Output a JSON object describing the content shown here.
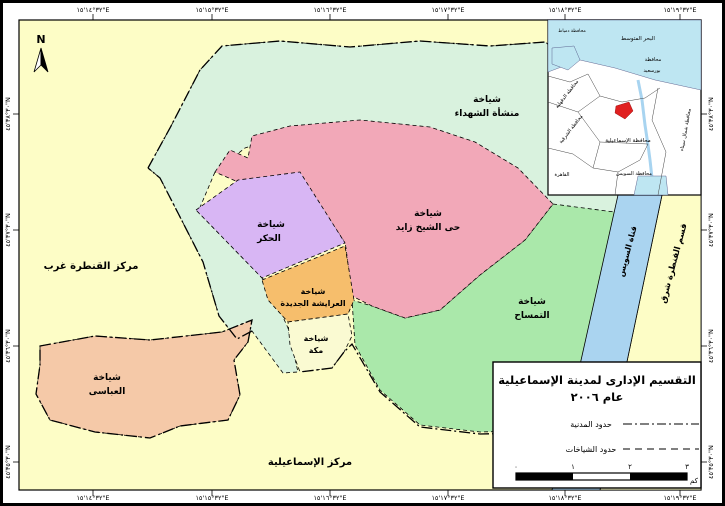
{
  "map": {
    "north_label": "N",
    "top_coords": [
      "٣٢°١٤'١٥\"E",
      "٣٢°١٥'١٥\"E",
      "٣٢°١٦'١٥\"E",
      "٣٢°١٧'١٥\"E",
      "٣٢°١٨'١٥\"E",
      "٣٢°١٩'١٥\"E"
    ],
    "bottom_coords": [
      "٣٢°١٤'١٥\"E",
      "٣٢°١٥'١٥\"E",
      "٣٢°١٦'١٥\"E",
      "٣٢°١٧'١٥\"E",
      "٣٢°١٨'١٥\"E",
      "٣٢°١٩'١٥\"E"
    ],
    "left_coords": [
      "٣٠°٣٨'٤٥\"N",
      "٣٠°٣٧'٤٥\"N",
      "٣٠°٣٦'٤٥\"N",
      "٣٠°٣٥'٤٥\"N"
    ],
    "right_coords": [
      "٣٠°٣٨'٤٥\"N",
      "٣٠°٣٧'٤٥\"N",
      "٣٠°٣٦'٤٥\"N",
      "٣٠°٣٥'٤٥\"N"
    ],
    "regions": {
      "qantara_gharb": {
        "label": "مركز القنطرة غرب",
        "color": "#FDFDC6"
      },
      "ismailia_markaz": {
        "label": "مركز الإسماعيلية",
        "color": "#FDFDC6"
      },
      "shohadaa": {
        "line1": "شياخة",
        "line2": "منشأة الشهداء",
        "color": "#D9F2DE"
      },
      "sheikh_zayed": {
        "line1": "شياخة",
        "line2": "حى الشيخ زايد",
        "color": "#F2A8B8"
      },
      "hakr": {
        "line1": "شياخة",
        "line2": "الحكر",
        "color": "#D8B6F4"
      },
      "arayisha": {
        "line1": "شياخة",
        "line2": "العرايشة الجديدة",
        "color": "#F6BE6C"
      },
      "mecca": {
        "line1": "شياخة",
        "line2": "مكة",
        "color": "#FAFAD2"
      },
      "temsah": {
        "line1": "شياخة",
        "line2": "التمساح",
        "color": "#AAE8AA"
      },
      "abbasi": {
        "line1": "شياخة",
        "line2": "العباسى",
        "color": "#F5C9A8"
      },
      "suez_canal": {
        "label": "قناة السويس",
        "color": "#AAD4F0"
      },
      "qantara_sharq": {
        "label": "قسم القنطرة شرق",
        "color": "#FDFDC6"
      }
    },
    "inset": {
      "sea": "البحر المتوسط",
      "damietta": "محافظة دمياط",
      "dakahlia": "محافظة الدقهلية",
      "sharqia": "محافظة الشرقية",
      "port_said_1": "محافظة",
      "port_said_2": "بورسعيد",
      "ismailia_gov": "محافظة الإسماعيلية",
      "north_sinai": "محافظة شمال سيناء",
      "suez_gov": "محافظة السويس",
      "cairo": "القاهرة",
      "sea_color": "#BEE6F2",
      "marker_color": "#E02020"
    },
    "legend": {
      "title_line1": "التقسيم الإدارى لمدينة الإسماعيلية",
      "title_line2": "عام ٢٠٠٦",
      "item1_label": "حدود المدنية",
      "item2_label": "حدود الشياخات",
      "scale_tick0": "٠",
      "scale_tick1": "١",
      "scale_tick2": "٢",
      "scale_tick3": "٣",
      "scale_unit": "كم"
    }
  }
}
